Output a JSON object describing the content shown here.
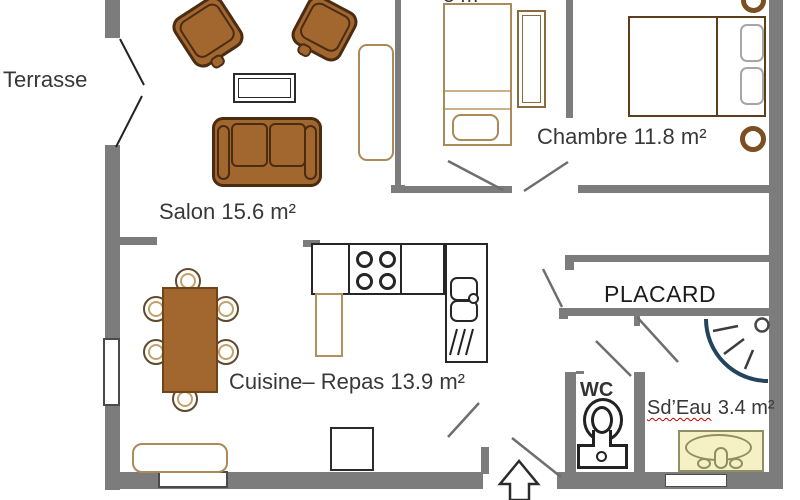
{
  "labels": {
    "terrasse": "Terrasse",
    "salon": "Salon 15.6 m²",
    "chambre_small_vertical": "CHAMBRE",
    "chambre_small_area": "8 m²",
    "chambre": "Chambre 11.8 m²",
    "cuisine_repas": "Cuisine– Repas 13.9 m²",
    "placard": "PLACARD",
    "wc": "WC",
    "sdeau_name": "Sd’Eau",
    "sdeau_area": "3.4 m²"
  },
  "colors": {
    "wall_gray": "#7c7c7c",
    "furniture_brown": "#A2662F",
    "furniture_outline_dark": "#4A2C12",
    "wood_tan": "#AB8A58",
    "kitchen_outline": "#262626",
    "door_arc_navy": "#24435C",
    "shower_pale_yellow": "#F5F1C4",
    "spellcheck_red": "#C00000",
    "text": "#383838"
  },
  "icons": {
    "salon": [
      "armchair-icon",
      "armchair-icon",
      "coffee-table-icon",
      "sofa-icon",
      "tv-unit-icon"
    ],
    "chambre_small": [
      "single-bed-icon",
      "wardrobe-icon"
    ],
    "chambre": [
      "double-bed-icon",
      "pillow-icon",
      "pillow-icon",
      "bedside-lamp-icon",
      "bedside-lamp-icon"
    ],
    "cuisine": [
      "dining-table-icon",
      "chair-icon",
      "hob-icon",
      "sink-icon",
      "cabinet-icon",
      "bench-icon",
      "side-table-icon"
    ],
    "wc": [
      "toilet-icon"
    ],
    "sdeau": [
      "washbasin-icon",
      "corner-shower-icon"
    ],
    "entry": [
      "entrance-arrow-icon"
    ]
  }
}
